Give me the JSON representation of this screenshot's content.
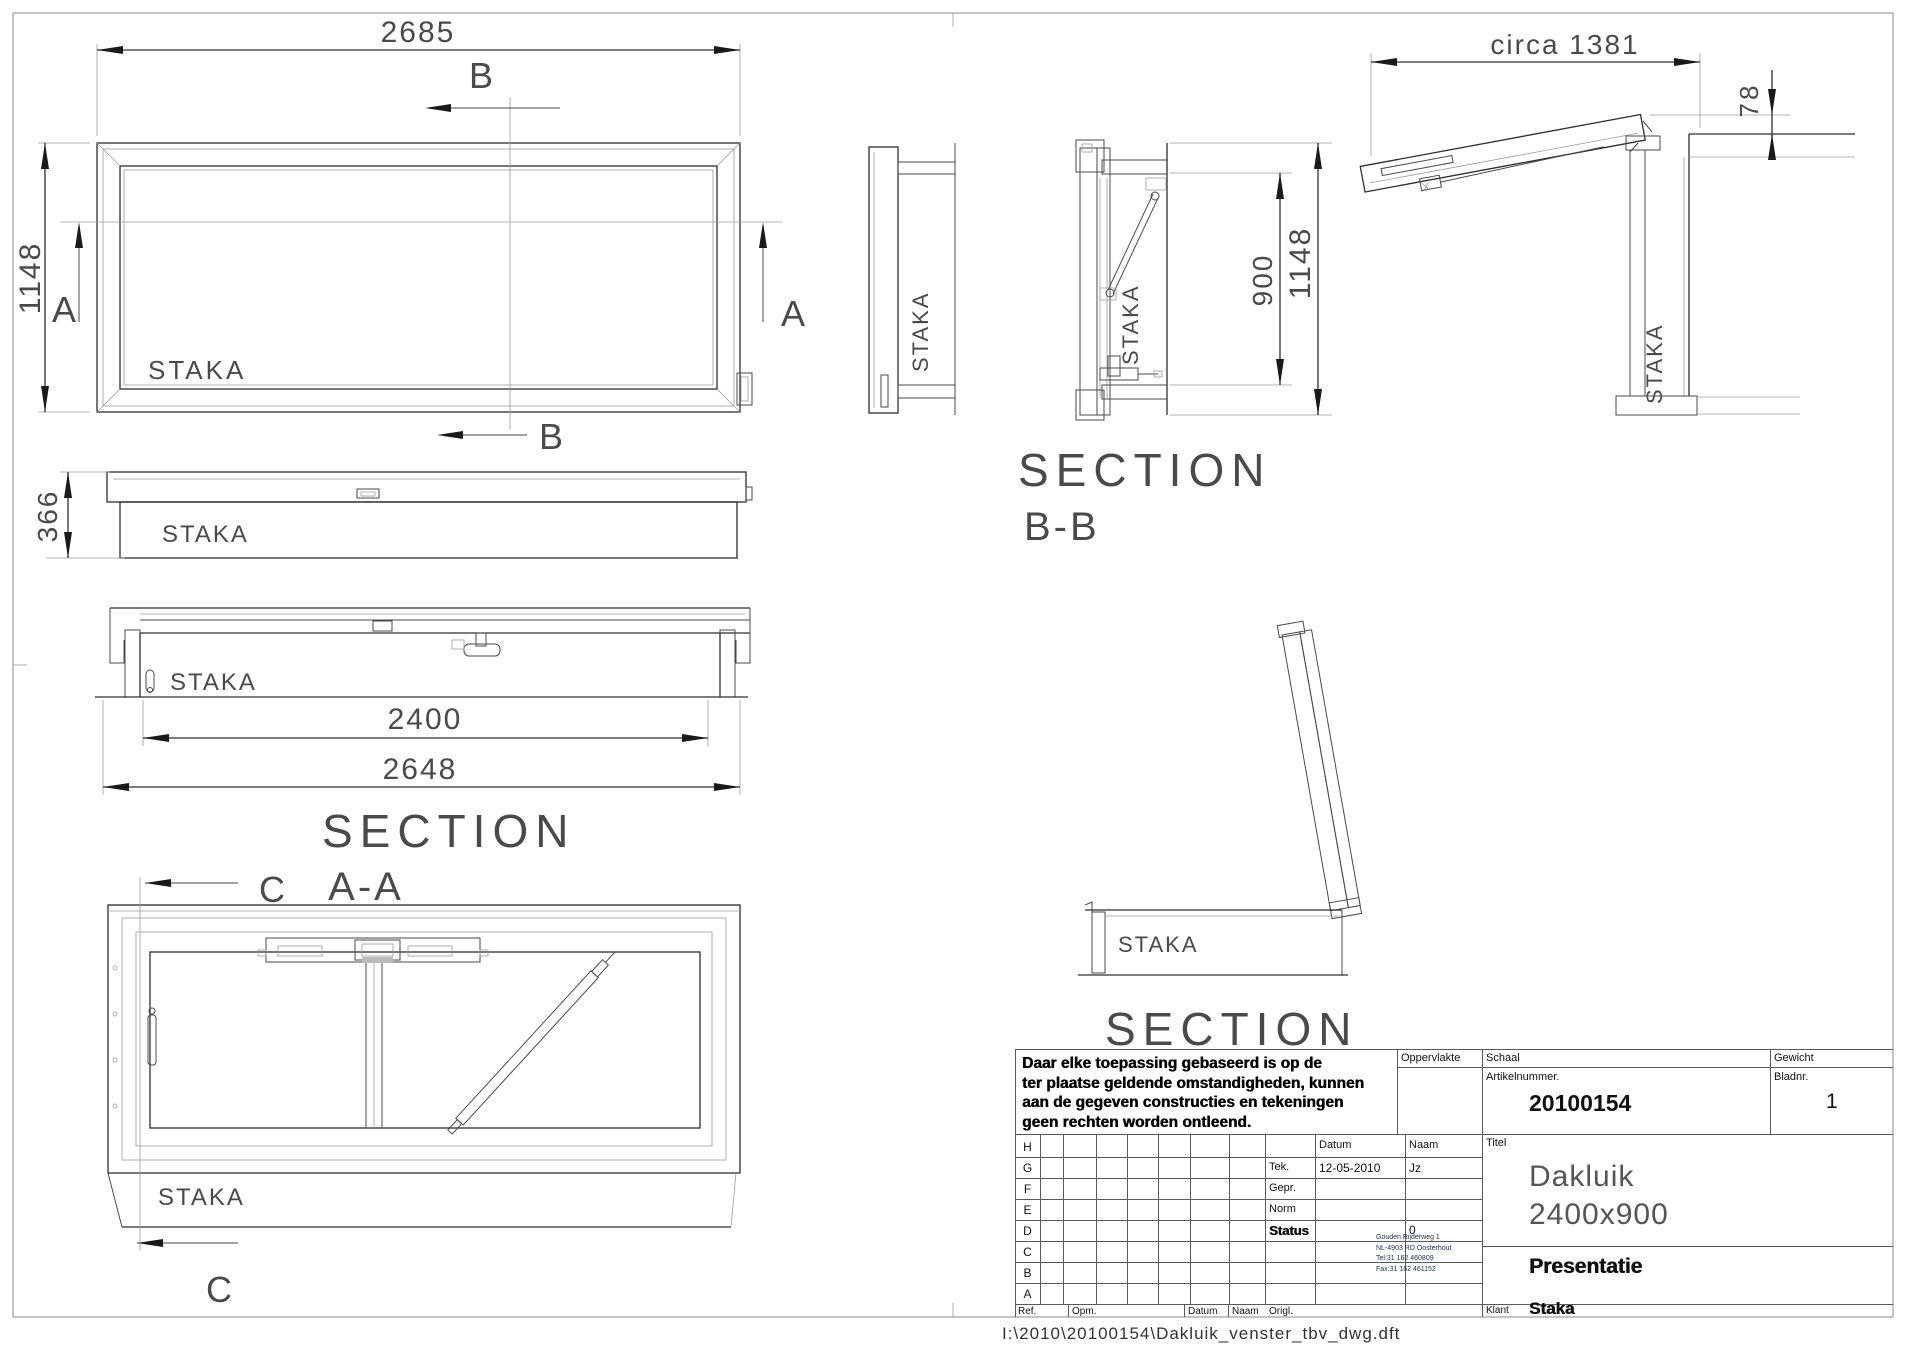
{
  "drawing": {
    "brand": "STAKA",
    "markers": {
      "a": "A",
      "b": "B",
      "c": "C"
    },
    "plan": {
      "dim_width": "2685",
      "dim_height": "1148"
    },
    "side": {
      "dim_height": "366"
    },
    "section_aa": {
      "word": "SECTION",
      "name": "A-A",
      "dim_inner": "2400",
      "dim_outer": "2648"
    },
    "section_bb": {
      "word": "SECTION",
      "name": "B-B",
      "dim_inner": "900",
      "dim_outer": "1148"
    },
    "open_view": {
      "dim_width": "circa 1381",
      "dim_height": "78"
    },
    "open_section": {
      "word": "SECTION"
    }
  },
  "title_block": {
    "disclaimer": [
      "Daar elke toepassing gebaseerd is op de",
      "ter plaatse geldende omstandigheden, kunnen",
      "aan de gegeven constructies en tekeningen",
      "geen rechten worden ontleend."
    ],
    "labels": {
      "oppervlakte": "Oppervlakte",
      "schaal": "Schaal",
      "gewicht": "Gewicht",
      "artikelnummer": "Artikelnummer.",
      "bladnr": "Bladnr.",
      "titel": "Titel",
      "klant": "Klant",
      "datum": "Datum",
      "naam": "Naam",
      "tek": "Tek.",
      "gepr": "Gepr.",
      "norm": "Norm",
      "status": "Status",
      "ref": "Ref.",
      "opm": "Opm.",
      "origl": "Origl."
    },
    "values": {
      "artikelnummer": "20100154",
      "bladnr": "1",
      "tek_datum": "12-05-2010",
      "tek_naam": "Jz",
      "status_value": "0",
      "product_line1": "Dakluik",
      "product_line2": "2400x900",
      "doc_type": "Presentatie",
      "klant": "Staka"
    },
    "row_letters": [
      "H",
      "G",
      "F",
      "E",
      "D",
      "C",
      "B",
      "A"
    ],
    "address": [
      "Gouden Rijderweg 1",
      "NL-4903 RD Oosterhout",
      "Tel:31 162 460809",
      "Fax:31 162 461152"
    ]
  },
  "footer": {
    "path": "I:\\2010\\20100154\\Dakluik_venster_tbv_dwg.dft"
  }
}
